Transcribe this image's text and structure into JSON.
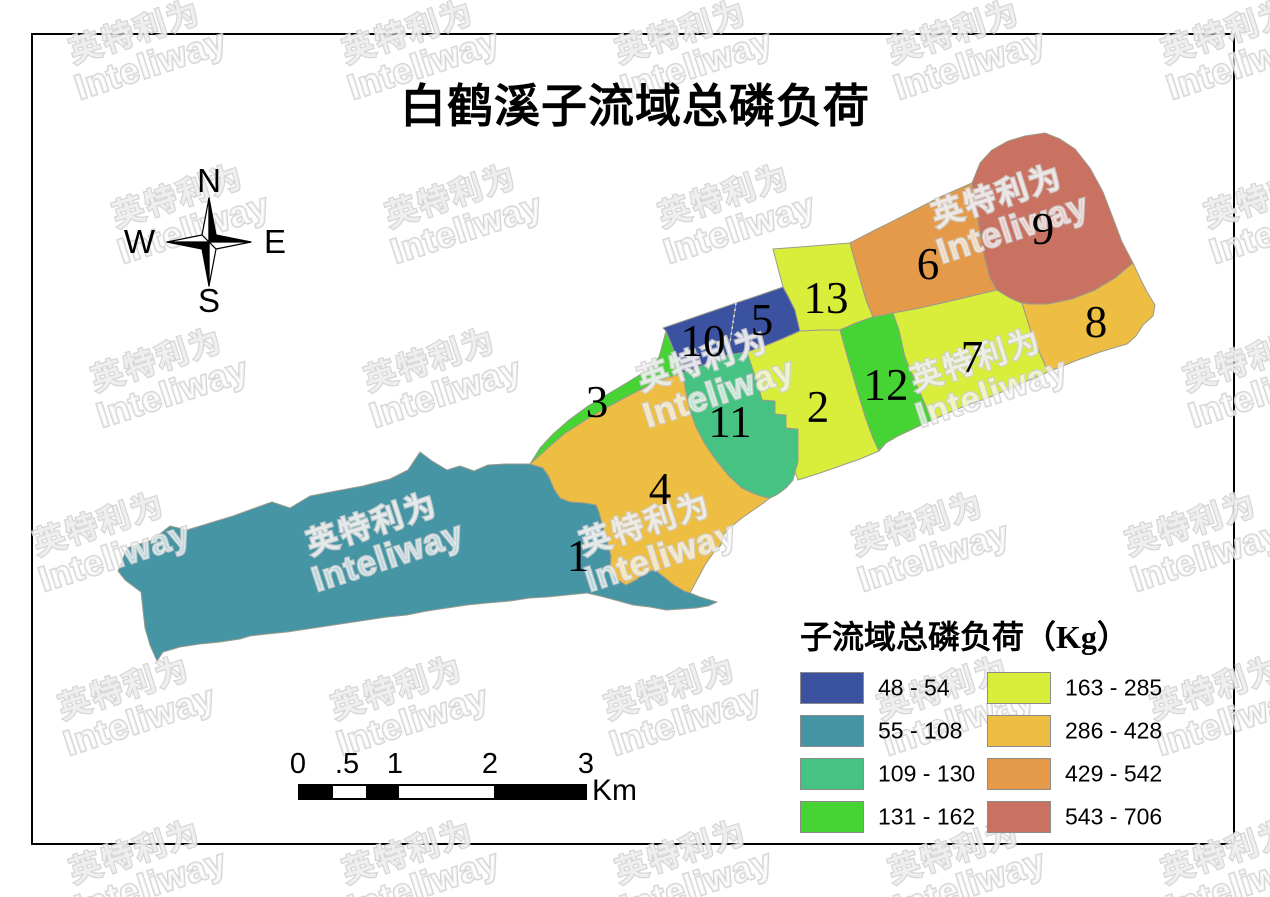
{
  "title": "白鹤溪子流域总磷负荷",
  "watermark": {
    "cn": "英特利为",
    "en": "Inteliway"
  },
  "compass": {
    "north": "N",
    "south": "S",
    "east": "E",
    "west": "W"
  },
  "legend": {
    "title": "子流域总磷负荷（Kg）",
    "items": [
      {
        "range": "48 - 54",
        "color": "#3b52a0"
      },
      {
        "range": "55 - 108",
        "color": "#4695a5"
      },
      {
        "range": "109 - 130",
        "color": "#46c383"
      },
      {
        "range": "131 - 162",
        "color": "#46d334"
      },
      {
        "range": "163 - 285",
        "color": "#d8ee3b"
      },
      {
        "range": "286 - 428",
        "color": "#edbe41"
      },
      {
        "range": "429 - 542",
        "color": "#e49a49"
      },
      {
        "range": "543 - 706",
        "color": "#ca7262"
      }
    ]
  },
  "scalebar": {
    "unit": "Km",
    "labels": [
      [
        "0",
        298
      ],
      [
        ".5",
        347
      ],
      [
        "1",
        395
      ],
      [
        "2",
        490
      ],
      [
        "3",
        586
      ]
    ],
    "bar": {
      "x": 298,
      "y": 784,
      "width": 289,
      "height": 16,
      "black_segments": [
        [
          0,
          33
        ],
        [
          66,
          33
        ],
        [
          194,
          91
        ]
      ]
    }
  },
  "map": {
    "boundary_stroke": "#9a9a8e",
    "dashed_boundary": {
      "x1": 736,
      "y1": 303,
      "x2": 728,
      "y2": 355
    },
    "regions": [
      {
        "id": "1",
        "tp_class": "55 - 108",
        "color": "#4695a5",
        "label": {
          "x": 578,
          "y": 556
        },
        "points": "118,571 127,548 152,540 170,526 187,530 210,523 233,516 255,508 272,502 290,508 310,496 336,491 363,486 390,479 408,470 420,452 432,461 447,470 460,466 474,471 488,465 505,464 530,464 543,468 549,477 554,489 560,498 570,502 585,503 596,505 599,512 603,527 607,540 611,556 610,570 618,580 626,585 636,580 646,572 655,570 664,577 674,585 684,591 690,593 700,597 710,600 717,602 708,606 696,608 682,609 666,610 650,607 633,605 615,600 600,596 587,593 567,595 547,597 530,598 510,601 487,603 467,605 447,608 427,611 407,615 387,617 367,620 347,623 327,626 307,629 287,632 267,634 250,636 240,639 220,642 200,644 180,647 163,652 157,661 150,645 145,628 143,610 141,592 133,586 125,580"
      },
      {
        "id": "3",
        "tp_class": "131 - 162",
        "color": "#46d334",
        "label": {
          "x": 597,
          "y": 402
        },
        "points": "530,464 540,448 553,434 569,420 588,406 608,394 628,382 646,371 659,357 666,331 683,373 666,378 648,386 628,396 606,408 584,421 564,434 549,447 538,457"
      },
      {
        "id": "4",
        "tp_class": "286 - 428",
        "color": "#edbe41",
        "label": {
          "x": 660,
          "y": 489
        },
        "points": "530,464 538,457 549,447 564,434 584,421 606,408 628,396 648,386 666,378 683,373 686,392 690,410 696,427 705,444 716,460 729,476 742,488 755,494 764,497 770,498 762,504 752,511 742,518 732,526 724,534 721,545 714,552 705,565 697,580 690,593 684,591 674,585 664,577 655,570 646,572 636,580 626,585 618,580 610,570 611,556 607,540 603,527 599,512 596,505 585,503 570,502 560,498 554,489 549,477 543,468"
      },
      {
        "id": "10",
        "tp_class": "48 - 54",
        "color": "#3b52a0",
        "label": {
          "x": 703,
          "y": 341
        },
        "points": "663,328 736,303 728,355 706,364 683,373 666,331"
      },
      {
        "id": "5",
        "tp_class": "48 - 54",
        "color": "#3b52a0",
        "label": {
          "x": 762,
          "y": 320
        },
        "points": "736,303 760,295 783,287 788,296 795,310 800,331 782,339 765,346 747,352 728,355"
      },
      {
        "id": "11",
        "tp_class": "109 - 130",
        "color": "#46c383",
        "label": {
          "x": 730,
          "y": 422
        },
        "points": "683,373 706,364 728,355 747,352 753,370 759,388 762,400 775,401 775,414 786,415 786,428 798,429 798,446 798,462 795,472 793,480 786,488 778,494 770,498 764,497 755,494 742,488 729,476 716,460 705,444 696,427 690,410 686,392"
      },
      {
        "id": "2",
        "tp_class": "163 - 285",
        "color": "#d8ee3b",
        "label": {
          "x": 818,
          "y": 407
        },
        "points": "747,352 765,346 782,339 800,331 820,330 840,330 849,362 858,393 866,419 873,438 879,451 860,459 840,466 820,473 798,480 795,472 798,462 798,446 798,429 786,428 786,415 775,414 775,401 762,400 759,388 753,370"
      },
      {
        "id": "13",
        "tp_class": "163 - 285",
        "color": "#d8ee3b",
        "label": {
          "x": 826,
          "y": 298
        },
        "points": "783,287 778,268 773,249 800,247 825,245 850,243 858,272 866,300 873,317 856,323 840,330 820,330 800,331 795,310 788,296"
      },
      {
        "id": "6",
        "tp_class": "429 - 542",
        "color": "#e49a49",
        "label": {
          "x": 928,
          "y": 264
        },
        "points": "850,243 875,230 905,215 940,197 972,183 978,220 984,255 990,278 997,290 955,300 920,308 893,313 884,315 873,317 866,300 858,272"
      },
      {
        "id": "12",
        "tp_class": "131 - 162",
        "color": "#46d334",
        "label": {
          "x": 886,
          "y": 385
        },
        "points": "840,330 856,323 873,317 884,315 893,313 899,330 905,357 915,381 924,402 932,420 915,428 898,436 886,443 879,451 873,438 866,419 858,393 849,362"
      },
      {
        "id": "7",
        "tp_class": "163 - 285",
        "color": "#d8ee3b",
        "label": {
          "x": 972,
          "y": 357
        },
        "points": "893,313 920,308 955,300 997,290 1005,295 1014,300 1022,303 1032,335 1042,358 1048,372 1020,384 990,397 960,408 932,420 924,402 915,381 905,357 899,330"
      },
      {
        "id": "9",
        "tp_class": "543 - 706",
        "color": "#ca7262",
        "label": {
          "x": 1043,
          "y": 229
        },
        "points": "972,183 980,163 992,150 1008,141 1025,136 1045,133 1060,139 1075,149 1090,168 1103,192 1113,218 1122,242 1133,263 1115,278 1095,290 1072,299 1048,304 1030,304 1022,303 1010,298 997,290 990,278 984,255 978,220"
      },
      {
        "id": "8",
        "tp_class": "286 - 428",
        "color": "#edbe41",
        "label": {
          "x": 1096,
          "y": 322
        },
        "points": "1022,303 1030,304 1048,304 1072,299 1095,290 1115,278 1133,263 1140,278 1147,292 1155,305 1153,316 1143,325 1136,336 1127,344 1120,346 1100,352 1075,361 1048,372 1042,358 1032,335"
      }
    ]
  }
}
